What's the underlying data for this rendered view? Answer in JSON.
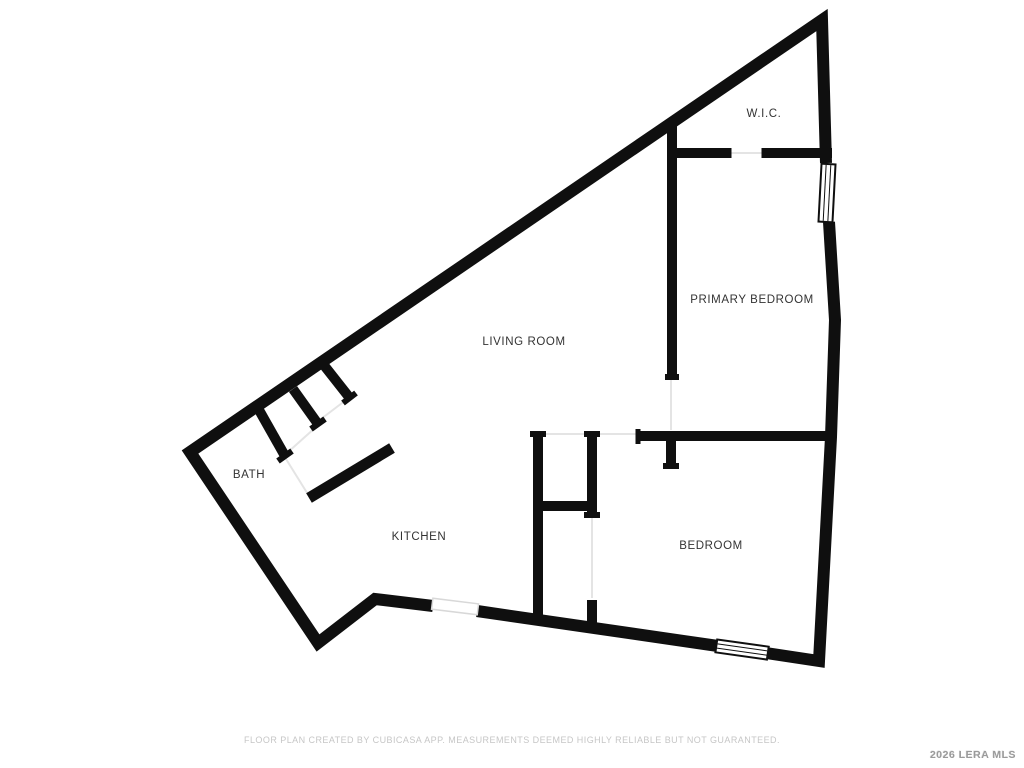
{
  "title": "Floor Plan",
  "rooms": [
    {
      "name": "wic",
      "label": "W.I.C.",
      "x": 764,
      "y": 114
    },
    {
      "name": "primary-bedroom",
      "label": "PRIMARY BEDROOM",
      "x": 752,
      "y": 300
    },
    {
      "name": "living-room",
      "label": "LIVING ROOM",
      "x": 524,
      "y": 342
    },
    {
      "name": "bath",
      "label": "BATH",
      "x": 249,
      "y": 475
    },
    {
      "name": "kitchen",
      "label": "KITCHEN",
      "x": 419,
      "y": 537
    },
    {
      "name": "bedroom",
      "label": "BEDROOM",
      "x": 711,
      "y": 546
    }
  ],
  "footer": {
    "disclaimer": "FLOOR PLAN CREATED BY CUBICASA APP. MEASUREMENTS DEEMED HIGHLY RELIABLE BUT NOT GUARANTEED.",
    "watermark": "2026 LERA MLS"
  },
  "colors": {
    "background": "#ffffff",
    "wall": "#0f0f0f",
    "label_text": "#333333",
    "opening_line": "#e4e4e4",
    "passage_border": "#d8d8d8",
    "footer_text": "#c6c6c6",
    "watermark_text": "#9a9a9a"
  },
  "floor_plan": {
    "canvas": {
      "width": 1024,
      "height": 768
    },
    "wall_chains": [
      {
        "w": 12,
        "points": [
          [
            826,
            163
          ],
          [
            822,
            20
          ],
          [
            190,
            452
          ],
          [
            318,
            643
          ],
          [
            375,
            599
          ],
          [
            433,
            606
          ]
        ]
      },
      {
        "w": 12,
        "points": [
          [
            477,
            611
          ],
          [
            718,
            646
          ]
        ]
      },
      {
        "w": 12,
        "points": [
          [
            766,
            653
          ],
          [
            819,
            661
          ],
          [
            831,
            437
          ],
          [
            835,
            320
          ],
          [
            829,
            222
          ]
        ]
      }
    ],
    "wall_segments": [
      {
        "name": "wic-bottom-left",
        "w": 10,
        "x1": 672,
        "y1": 153,
        "x2": 729,
        "y2": 153
      },
      {
        "name": "wic-bottom-right",
        "w": 10,
        "x1": 764,
        "y1": 153,
        "x2": 832,
        "y2": 153
      },
      {
        "name": "primary-left-wall",
        "w": 10,
        "x1": 672,
        "y1": 126,
        "x2": 672,
        "y2": 378
      },
      {
        "name": "bedroom-top-wall",
        "w": 10,
        "x1": 638,
        "y1": 436,
        "x2": 832,
        "y2": 436
      },
      {
        "name": "bedroom-door-stub",
        "w": 10,
        "x1": 671,
        "y1": 436,
        "x2": 671,
        "y2": 466
      },
      {
        "name": "closet-wall-left",
        "w": 10,
        "x1": 538,
        "y1": 433,
        "x2": 538,
        "y2": 622
      },
      {
        "name": "closet-wall-right-top",
        "w": 10,
        "x1": 592,
        "y1": 433,
        "x2": 592,
        "y2": 515
      },
      {
        "name": "closet-wall-right-bottom",
        "w": 10,
        "x1": 592,
        "y1": 600,
        "x2": 592,
        "y2": 630
      },
      {
        "name": "closet-wall-middle",
        "w": 10,
        "x1": 538,
        "y1": 506,
        "x2": 592,
        "y2": 506
      },
      {
        "name": "bath-stub-1",
        "w": 10,
        "x1": 323,
        "y1": 364,
        "x2": 349,
        "y2": 397
      },
      {
        "name": "bath-stub-2",
        "w": 10,
        "x1": 293,
        "y1": 389,
        "x2": 318,
        "y2": 424
      },
      {
        "name": "bath-stub-3",
        "w": 10,
        "x1": 259,
        "y1": 410,
        "x2": 285,
        "y2": 456
      },
      {
        "name": "bath-kitchen-wall",
        "w": 11,
        "x1": 309,
        "y1": 498,
        "x2": 392,
        "y2": 448
      }
    ],
    "wall_caps": [
      {
        "w": 6,
        "x1": 530,
        "y1": 434,
        "x2": 546,
        "y2": 434
      },
      {
        "w": 6,
        "x1": 584,
        "y1": 434,
        "x2": 600,
        "y2": 434
      },
      {
        "w": 6,
        "x1": 584,
        "y1": 515,
        "x2": 600,
        "y2": 515
      },
      {
        "w": 6,
        "x1": 663,
        "y1": 466,
        "x2": 679,
        "y2": 466
      },
      {
        "w": 6,
        "x1": 665,
        "y1": 377,
        "x2": 679,
        "y2": 377
      },
      {
        "w": 5,
        "x1": 638,
        "y1": 429,
        "x2": 638,
        "y2": 444
      },
      {
        "w": 5,
        "x1": 729,
        "y1": 148,
        "x2": 729,
        "y2": 158
      },
      {
        "w": 5,
        "x1": 764,
        "y1": 148,
        "x2": 764,
        "y2": 158
      },
      {
        "w": 6,
        "x1": 343,
        "y1": 403,
        "x2": 356,
        "y2": 393
      },
      {
        "w": 6,
        "x1": 311,
        "y1": 429,
        "x2": 325,
        "y2": 419
      },
      {
        "w": 6,
        "x1": 278,
        "y1": 461,
        "x2": 292,
        "y2": 451
      }
    ],
    "door_lines": [
      {
        "name": "primary-bedroom-door",
        "x1": 671,
        "y1": 380,
        "x2": 671,
        "y2": 430
      },
      {
        "name": "wic-door",
        "x1": 731,
        "y1": 153,
        "x2": 762,
        "y2": 153
      },
      {
        "name": "bedroom-door",
        "x1": 594,
        "y1": 434,
        "x2": 636,
        "y2": 434
      },
      {
        "name": "living-closet-opening",
        "x1": 540,
        "y1": 434,
        "x2": 590,
        "y2": 434
      },
      {
        "name": "closet-door",
        "x1": 592,
        "y1": 517,
        "x2": 592,
        "y2": 598
      },
      {
        "name": "bath-door",
        "x1": 286,
        "y1": 459,
        "x2": 309,
        "y2": 496
      },
      {
        "name": "hall-closet-slider-1",
        "x1": 287,
        "y1": 453,
        "x2": 316,
        "y2": 427
      },
      {
        "name": "hall-closet-slider-2",
        "x1": 321,
        "y1": 419,
        "x2": 346,
        "y2": 400
      }
    ],
    "windows": [
      {
        "name": "primary-bedroom-window",
        "x": 820,
        "y": 164,
        "w": 14,
        "h": 58,
        "angle": 3,
        "cx": 827,
        "cy": 193
      },
      {
        "name": "bedroom-window",
        "x": 716,
        "y": 643,
        "w": 52,
        "h": 13,
        "angle": 8,
        "cx": 742,
        "cy": 650
      }
    ],
    "passages": [
      {
        "name": "kitchen-opening",
        "x": 432,
        "y": 601,
        "w": 46,
        "h": 11,
        "angle": 7,
        "cx": 455,
        "cy": 607
      }
    ]
  }
}
